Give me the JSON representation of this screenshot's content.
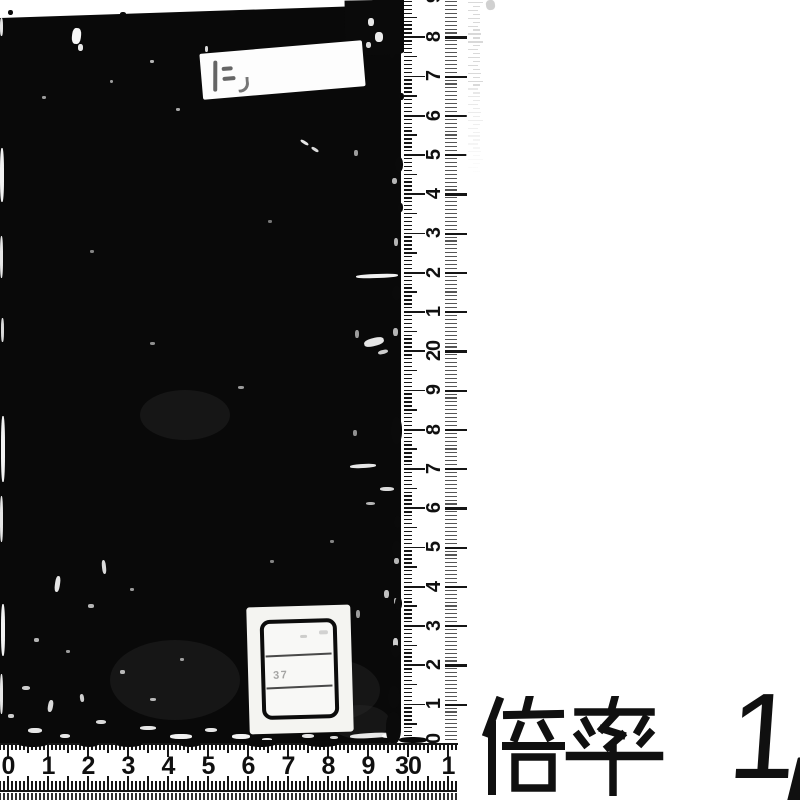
{
  "magnification": {
    "label": "倍率",
    "value": "1/",
    "value_digit": "1"
  },
  "vertical_ruler": {
    "unit": "cm",
    "labels_top_to_bottom": [
      "9",
      "8",
      "7",
      "6",
      "5",
      "4",
      "3",
      "2",
      "1",
      "20",
      "9",
      "8",
      "7",
      "6",
      "5",
      "4",
      "3",
      "2",
      "1",
      "10"
    ]
  },
  "horizontal_ruler": {
    "unit": "cm",
    "labels_left_to_right": [
      "0",
      "1",
      "2",
      "3",
      "4",
      "5",
      "6",
      "7",
      "8",
      "9",
      "30",
      "1"
    ]
  },
  "call_number_label": {
    "faint_text": "37"
  },
  "colors": {
    "ink": "#101010",
    "book": "#090909",
    "paper": "#ffffff",
    "faint_mark": "#8d8d8d"
  }
}
